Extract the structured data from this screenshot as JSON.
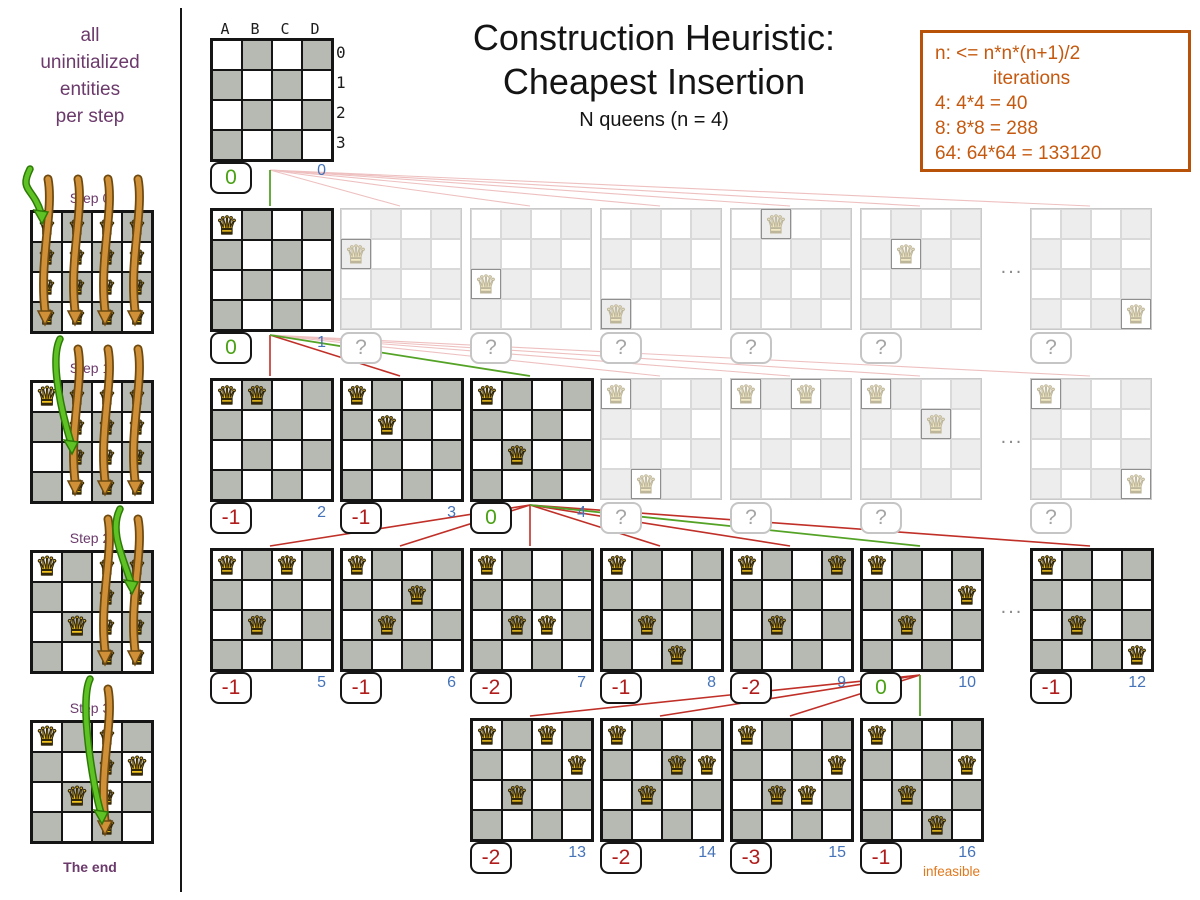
{
  "sidebar": {
    "caption_lines": [
      "all",
      "uninitialized",
      "entities",
      "per step"
    ],
    "end_label": "The end",
    "steps": [
      {
        "label": "Step 0",
        "placed_queens": [],
        "candidate_cols": [
          0,
          1,
          2,
          3
        ],
        "green_arrow": {
          "col": 0,
          "row": 0
        }
      },
      {
        "label": "Step 1",
        "placed_queens": [
          [
            0,
            0
          ]
        ],
        "candidate_cols": [
          1,
          2,
          3
        ],
        "green_arrow": {
          "col": 1,
          "row": 2
        }
      },
      {
        "label": "Step 2",
        "placed_queens": [
          [
            0,
            0
          ],
          [
            1,
            2
          ]
        ],
        "candidate_cols": [
          2,
          3
        ],
        "green_arrow": {
          "col": 3,
          "row": 1
        }
      },
      {
        "label": "Step 3",
        "placed_queens": [
          [
            0,
            0
          ],
          [
            1,
            2
          ],
          [
            3,
            1
          ]
        ],
        "candidate_cols": [
          2
        ],
        "green_arrow": {
          "col": 2,
          "row": 3
        }
      }
    ]
  },
  "header": {
    "title_line1": "Construction Heuristic:",
    "title_line2": "Cheapest Insertion",
    "subtitle": "N queens (n = 4)"
  },
  "info_box": {
    "lines": [
      "n: <= n*n*(n+1)/2",
      "iterations",
      "4: 4*4 = 40",
      "8: 8*8 = 288",
      "64: 64*64 = 133120"
    ]
  },
  "root_board": {
    "col_labels": [
      "A",
      "B",
      "C",
      "D"
    ],
    "row_labels": [
      "0",
      "1",
      "2",
      "3"
    ],
    "score": "0",
    "score_color": "green",
    "iteration": "0"
  },
  "tree_rows": [
    {
      "ellipsis": "...",
      "boards": [
        {
          "slot": 0,
          "queens": [
            [
              0,
              0
            ]
          ],
          "score": "0",
          "score_color": "green",
          "iteration": "1",
          "selected": true
        },
        {
          "slot": 1,
          "queens": [
            [
              0,
              1
            ]
          ],
          "faded": true,
          "score": "?"
        },
        {
          "slot": 2,
          "queens": [
            [
              0,
              2
            ]
          ],
          "faded": true,
          "score": "?"
        },
        {
          "slot": 3,
          "queens": [
            [
              0,
              3
            ]
          ],
          "faded": true,
          "score": "?"
        },
        {
          "slot": 4,
          "queens": [
            [
              1,
              0
            ]
          ],
          "faded": true,
          "score": "?"
        },
        {
          "slot": 5,
          "queens": [
            [
              1,
              1
            ]
          ],
          "faded": true,
          "score": "?"
        },
        {
          "slot": 6,
          "queens": [
            [
              3,
              3
            ]
          ],
          "faded": true,
          "score": "?"
        }
      ]
    },
    {
      "ellipsis": "...",
      "boards": [
        {
          "slot": 0,
          "queens": [
            [
              0,
              0
            ],
            [
              1,
              0
            ]
          ],
          "score": "-1",
          "score_color": "red",
          "iteration": "2"
        },
        {
          "slot": 1,
          "queens": [
            [
              0,
              0
            ],
            [
              1,
              1
            ]
          ],
          "score": "-1",
          "score_color": "red",
          "iteration": "3"
        },
        {
          "slot": 2,
          "queens": [
            [
              0,
              0
            ],
            [
              1,
              2
            ]
          ],
          "score": "0",
          "score_color": "green",
          "iteration": "4",
          "selected": true
        },
        {
          "slot": 3,
          "queens": [
            [
              0,
              0
            ],
            [
              1,
              3
            ]
          ],
          "faded": true,
          "score": "?"
        },
        {
          "slot": 4,
          "queens": [
            [
              0,
              0
            ],
            [
              2,
              0
            ]
          ],
          "faded": true,
          "score": "?"
        },
        {
          "slot": 5,
          "queens": [
            [
              0,
              0
            ],
            [
              2,
              1
            ]
          ],
          "faded": true,
          "score": "?"
        },
        {
          "slot": 6,
          "queens": [
            [
              0,
              0
            ],
            [
              3,
              3
            ]
          ],
          "faded": true,
          "score": "?"
        }
      ]
    },
    {
      "ellipsis": "...",
      "boards": [
        {
          "slot": 0,
          "queens": [
            [
              0,
              0
            ],
            [
              1,
              2
            ],
            [
              2,
              0
            ]
          ],
          "score": "-1",
          "score_color": "red",
          "iteration": "5"
        },
        {
          "slot": 1,
          "queens": [
            [
              0,
              0
            ],
            [
              1,
              2
            ],
            [
              2,
              1
            ]
          ],
          "score": "-1",
          "score_color": "red",
          "iteration": "6"
        },
        {
          "slot": 2,
          "queens": [
            [
              0,
              0
            ],
            [
              1,
              2
            ],
            [
              2,
              2
            ]
          ],
          "score": "-2",
          "score_color": "red",
          "iteration": "7"
        },
        {
          "slot": 3,
          "queens": [
            [
              0,
              0
            ],
            [
              1,
              2
            ],
            [
              2,
              3
            ]
          ],
          "score": "-1",
          "score_color": "red",
          "iteration": "8"
        },
        {
          "slot": 4,
          "queens": [
            [
              0,
              0
            ],
            [
              1,
              2
            ],
            [
              3,
              0
            ]
          ],
          "score": "-2",
          "score_color": "red",
          "iteration": "9"
        },
        {
          "slot": 5,
          "queens": [
            [
              0,
              0
            ],
            [
              1,
              2
            ],
            [
              3,
              1
            ]
          ],
          "score": "0",
          "score_color": "green",
          "iteration": "10",
          "selected": true
        },
        {
          "slot": 6,
          "queens": [
            [
              0,
              0
            ],
            [
              1,
              2
            ],
            [
              3,
              3
            ]
          ],
          "score": "-1",
          "score_color": "red",
          "iteration": "12"
        }
      ]
    },
    {
      "boards": [
        {
          "slot": 2,
          "queens": [
            [
              0,
              0
            ],
            [
              1,
              2
            ],
            [
              3,
              1
            ],
            [
              2,
              0
            ]
          ],
          "score": "-2",
          "score_color": "red",
          "iteration": "13"
        },
        {
          "slot": 3,
          "queens": [
            [
              0,
              0
            ],
            [
              1,
              2
            ],
            [
              3,
              1
            ],
            [
              2,
              1
            ]
          ],
          "score": "-2",
          "score_color": "red",
          "iteration": "14"
        },
        {
          "slot": 4,
          "queens": [
            [
              0,
              0
            ],
            [
              1,
              2
            ],
            [
              3,
              1
            ],
            [
              2,
              2
            ]
          ],
          "score": "-3",
          "score_color": "red",
          "iteration": "15"
        },
        {
          "slot": 5,
          "queens": [
            [
              0,
              0
            ],
            [
              1,
              2
            ],
            [
              3,
              1
            ],
            [
              2,
              3
            ]
          ],
          "score": "-1",
          "score_color": "red",
          "iteration": "16",
          "selected": true,
          "note": "infeasible"
        }
      ]
    }
  ],
  "glyphs": {
    "queen": "♛",
    "question": "?",
    "ellipsis": "..."
  },
  "colors": {
    "selected_green": "#4aa114",
    "score_red": "#b01c1c",
    "iteration_blue": "#4573b9",
    "line_red": "#c03028",
    "line_green": "#54a327",
    "line_pink": "#eec0c0",
    "accent_orange": "#c5590f",
    "purple": "#6b3a6b",
    "infeasible_orange": "#e0781c",
    "board_dark_cell": "#b6bab2",
    "faded_dark_cell": "#ededed",
    "queen_gold": "#f1c41f",
    "arrow_orange": "#d09038",
    "arrow_green": "#5fc224"
  }
}
